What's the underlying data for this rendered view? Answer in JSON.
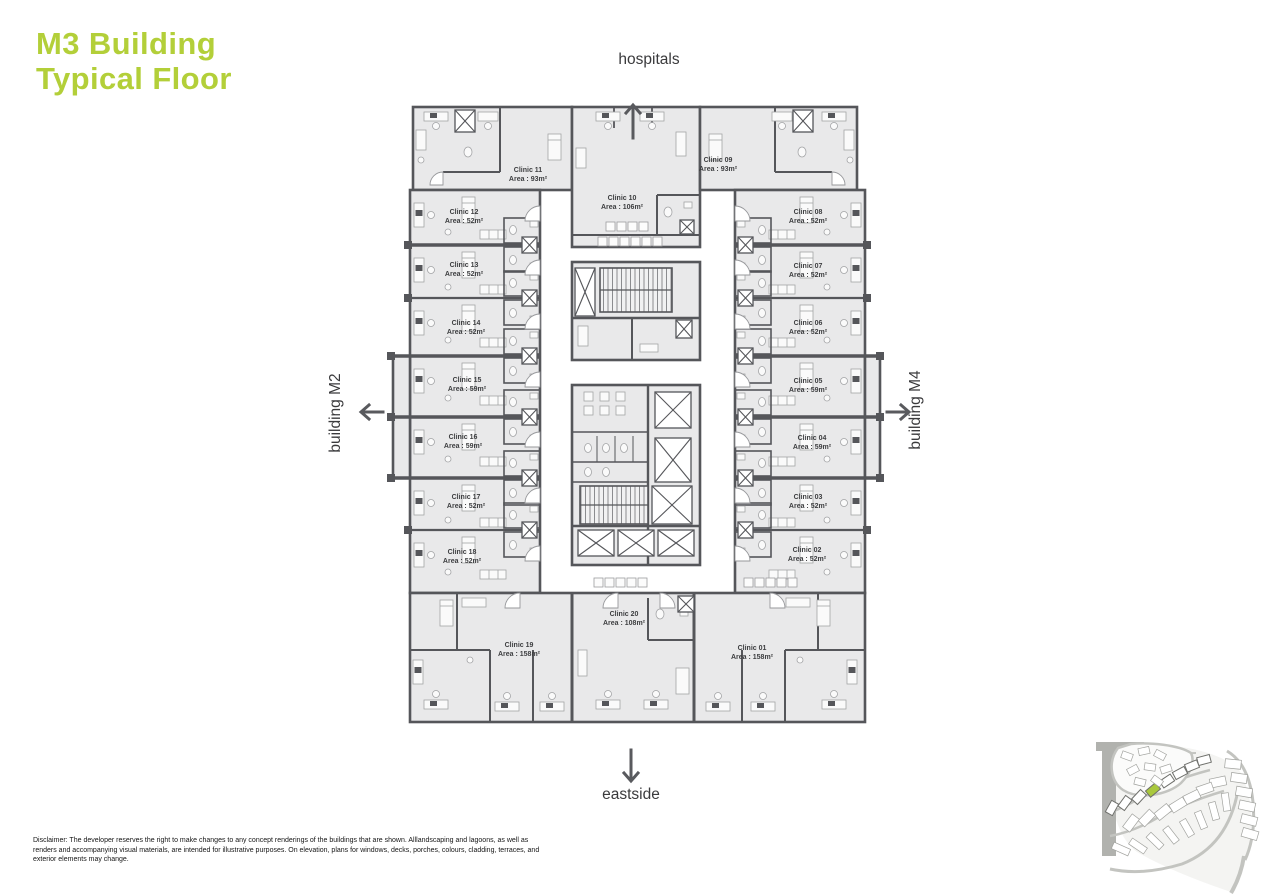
{
  "title": {
    "line1": "M3 Building",
    "line2": "Typical Floor"
  },
  "directions": {
    "top": "hospitals",
    "bottom": "eastside",
    "left": "building M2",
    "right": "building M4"
  },
  "clinics": [
    {
      "name": "Clinic 01",
      "area": "Area : 158m²"
    },
    {
      "name": "Clinic 02",
      "area": "Area : 52m²"
    },
    {
      "name": "Clinic 03",
      "area": "Area : 52m²"
    },
    {
      "name": "Clinic 04",
      "area": "Area : 59m²"
    },
    {
      "name": "Clinic 05",
      "area": "Area : 59m²"
    },
    {
      "name": "Clinic 06",
      "area": "Area : 52m²"
    },
    {
      "name": "Clinic 07",
      "area": "Area : 52m²"
    },
    {
      "name": "Clinic 08",
      "area": "Area : 52m²"
    },
    {
      "name": "Clinic 09",
      "area": "Area : 93m²"
    },
    {
      "name": "Clinic 10",
      "area": "Area : 106m²"
    },
    {
      "name": "Clinic 11",
      "area": "Area : 93m²"
    },
    {
      "name": "Clinic 12",
      "area": "Area : 52m²"
    },
    {
      "name": "Clinic 13",
      "area": "Area : 52m²"
    },
    {
      "name": "Clinic 14",
      "area": "Area : 52m²"
    },
    {
      "name": "Clinic 15",
      "area": "Area : 59m²"
    },
    {
      "name": "Clinic 16",
      "area": "Area : 59m²"
    },
    {
      "name": "Clinic 17",
      "area": "Area : 52m²"
    },
    {
      "name": "Clinic 18",
      "area": "Area : 52m²"
    },
    {
      "name": "Clinic 19",
      "area": "Area : 158m²"
    },
    {
      "name": "Clinic 20",
      "area": "Area : 108m²"
    }
  ],
  "disclaimer": {
    "lines": [
      "Disclaimer: The developer reserves the right to make changes to any concept renderings of the buildings that are shown. Alllandscaping and lagoons, as well as",
      "renders and accompanying visual materials, are intended for illustrative purposes. On elevation, plans for windows, decks, porches, colours, cladding, terraces, and",
      "exterior elements may change."
    ]
  },
  "colors": {
    "accent": "#b3cf39",
    "wall": "#55565a",
    "room_fill": "#e9e9ea",
    "minimap_highlight": "#a9c83d"
  }
}
